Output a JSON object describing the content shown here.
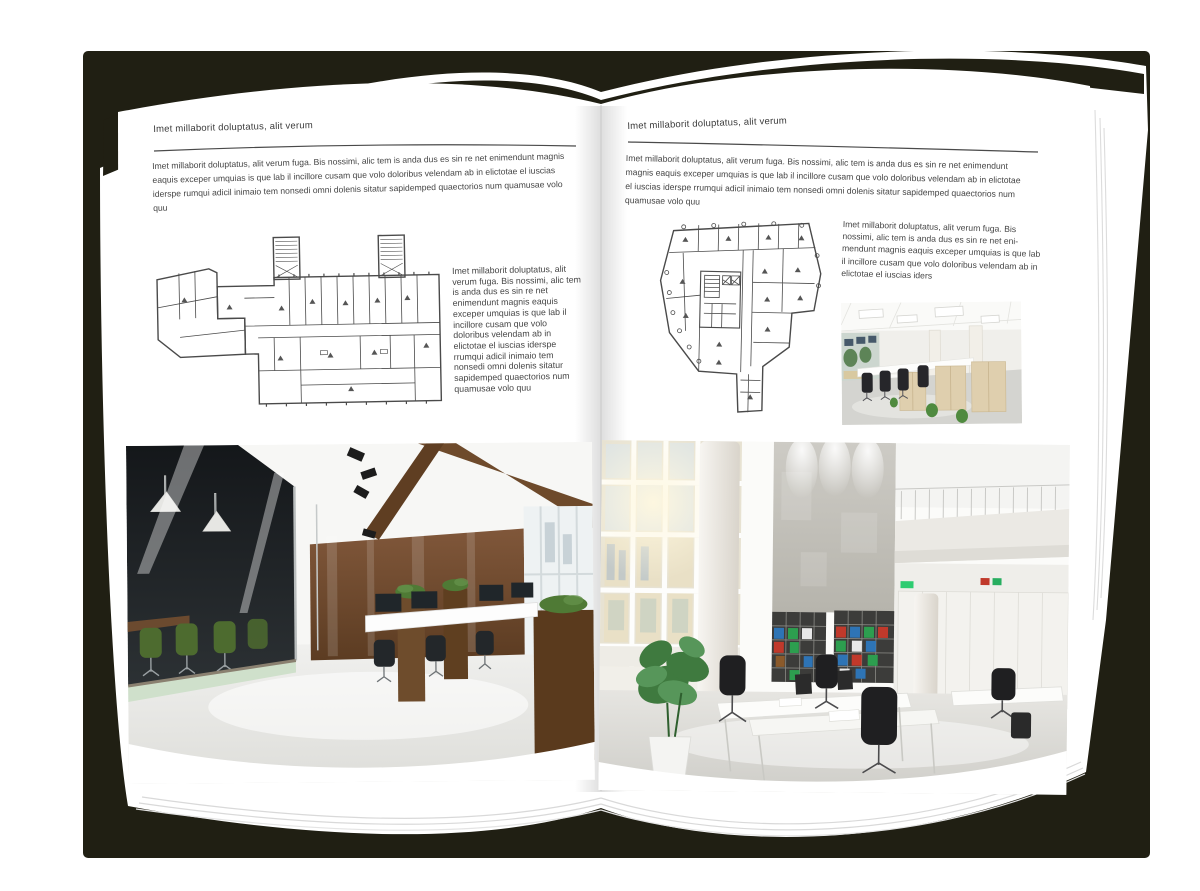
{
  "document": {
    "type": "magazine-spread-mockup",
    "left_page": {
      "header": "Imet millaborit doluptatus, alit verum",
      "intro": "Imet millaborit doluptatus, alit verum fuga. Bis nossimi, alic tem is anda dus es sin re net enimendunt magnis eaquis exceper umquias is que lab il incillore cusam que volo doloribus velendam ab in elictotae el iuscias iderspe rumqui adicil inimaio tem nonsedi omni dolenis sitatur sapidemped quaectorios num quamusae volo quu",
      "side_text": "Imet millaborit doluptatus, alit verum fuga. Bis nossimi, alic tem is anda dus es sin re net enimendunt magnis eaquis exceper umquias is que lab il incillore cusam que volo doloribus velendam ab in elictotae el iuscias iderspe rrumqui adicil inimaio tem nonsedi omni dolenis sitatur sapidemped quaectorios num quamusae volo quu",
      "images": {
        "floor_plan": "architectural-floor-plan-drawing",
        "photo": "dark-loft-office-interior-photo"
      }
    },
    "right_page": {
      "header": "Imet millaborit doluptatus, alit verum",
      "intro": "Imet millaborit doluptatus, alit verum fuga. Bis nossimi, alic tem is anda dus es sin re net enimendunt magnis eaquis exceper umquias is que lab il incillore cusam que volo doloribus velendam ab in elictotae el iuscias iderspe rrumqui adicil inimaio tem nonsedi omni dolenis sitatur sapidemped quaectorios num quamusae volo quu",
      "side_text": "Imet millaborit doluptatus, alit verum fuga. Bis nossimi, alic tem is anda dus es sin re net eni­mendunt magnis eaquis exceper umquias is que lab il incillore cusam que volo doloribus velendam ab in elictotae el iuscias iders",
      "images": {
        "floor_plan": "architectural-floor-plan-drawing",
        "photo_small": "bright-cubicle-office-interior-photo",
        "photo_large": "white-double-height-office-interior-photo"
      }
    },
    "colors": {
      "backdrop": "#201f13",
      "page": "#ffffff",
      "heading_text": "#3a3a3a",
      "body_text": "#454545",
      "rule_line": "#4a4a4a",
      "plan_line": "#4a4a4a"
    }
  }
}
